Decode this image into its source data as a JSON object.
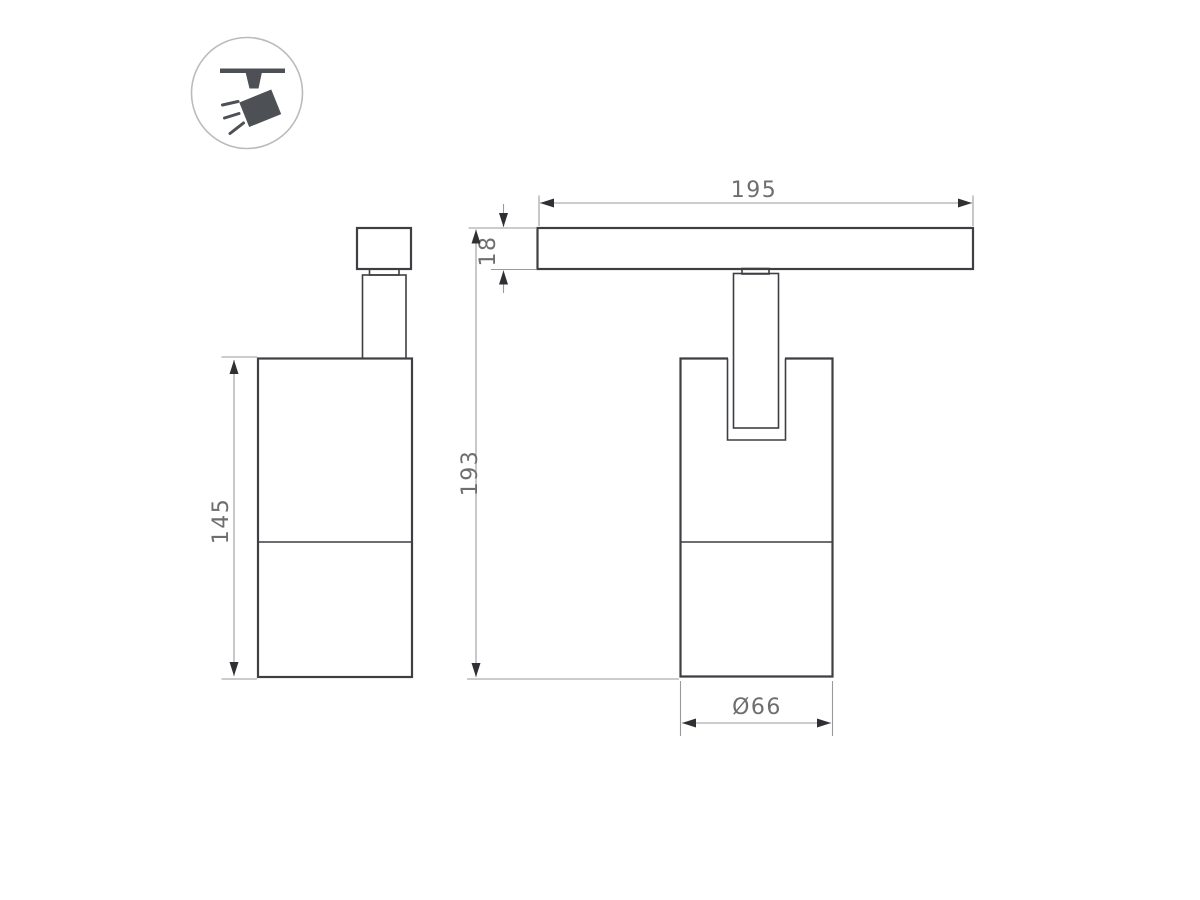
{
  "colors": {
    "background": "#ffffff",
    "outline": "#3d3f43",
    "dimension": "#9a9a9a",
    "arrow": "#2f3033",
    "text": "#6e6e6e",
    "icon": "#4d5156",
    "icon_circle": "#b9bcbf"
  },
  "drawing": {
    "type": "technical-dimension-drawing",
    "subject": "track-mounted spotlight, side view and front view with mounting icon"
  },
  "dimensions": {
    "track_length": "195",
    "track_height": "18",
    "total_height": "193",
    "body_height": "145",
    "body_diameter": "Ø66"
  }
}
